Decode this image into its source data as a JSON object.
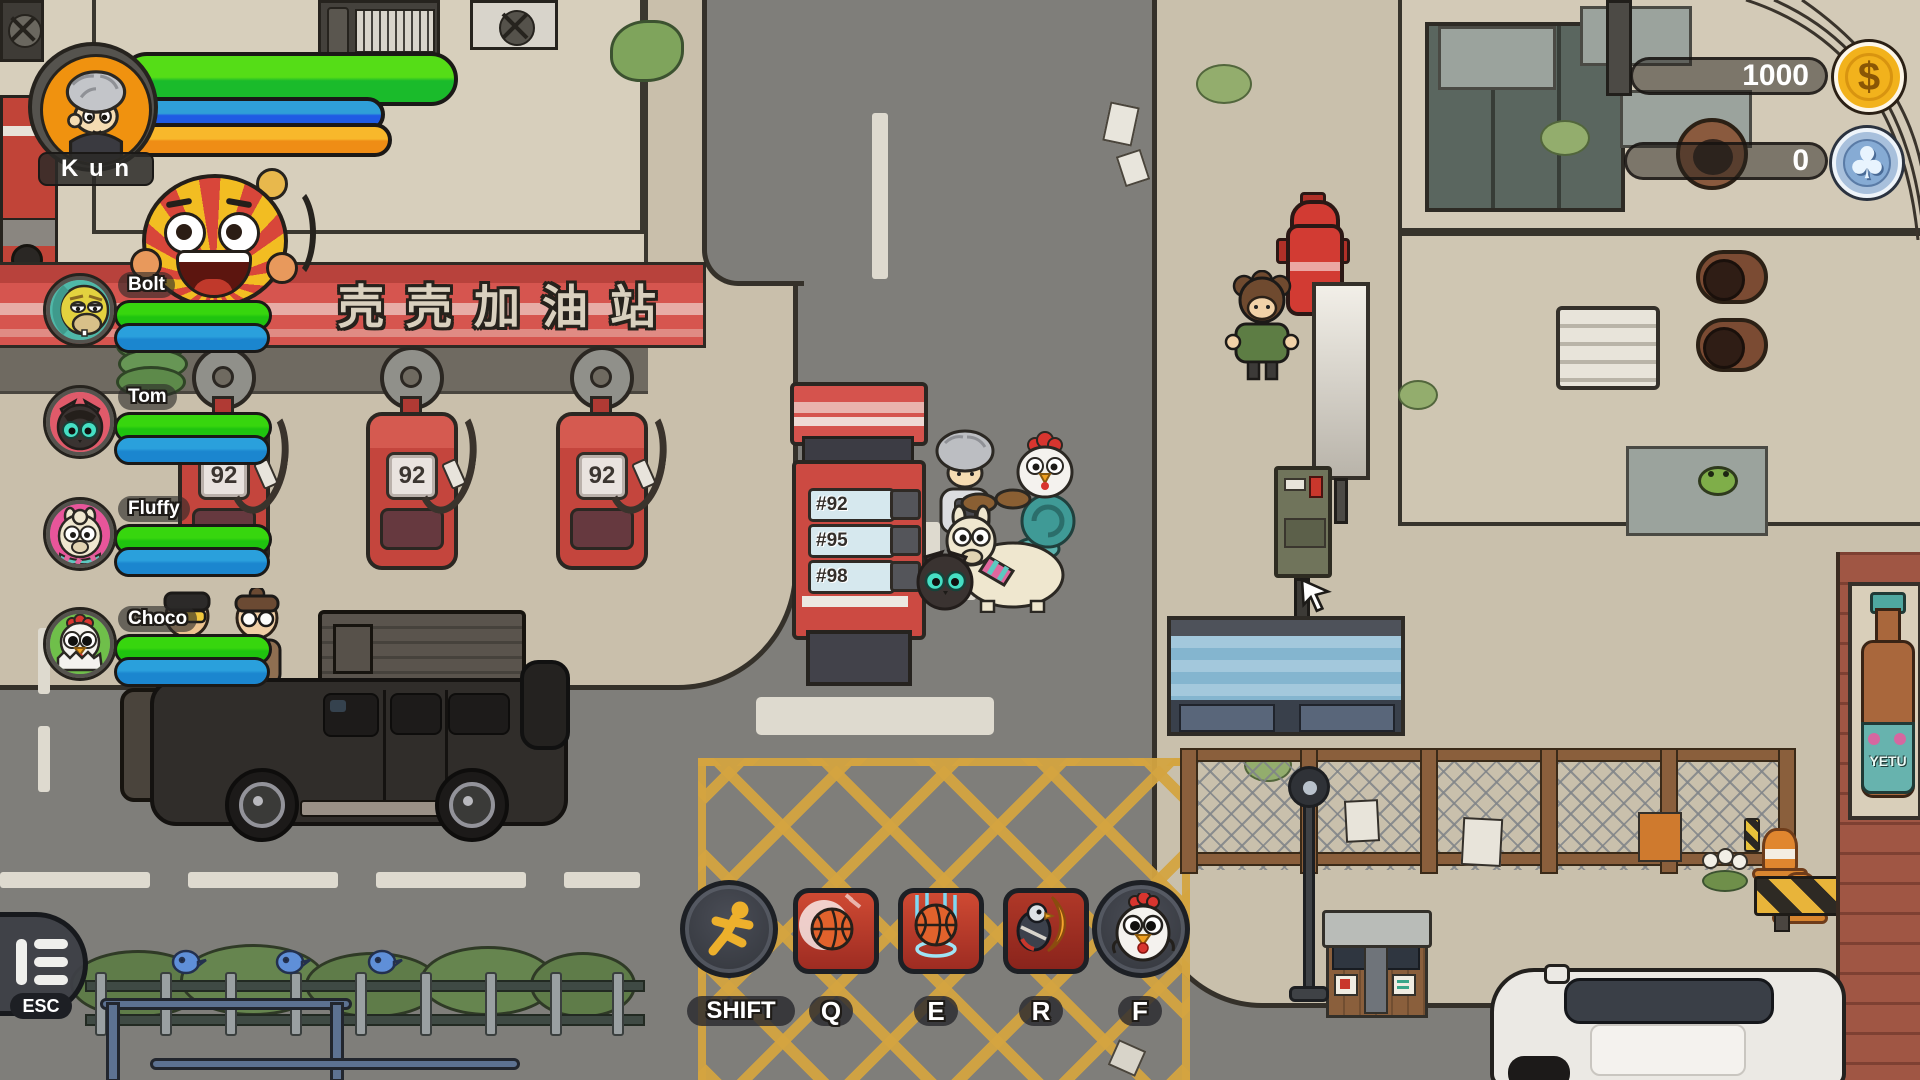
{
  "player": {
    "name": "K u n",
    "hp_pct": 100,
    "mp_pct": 78,
    "stamina_pct": 80
  },
  "party": [
    {
      "name": "Bolt",
      "species": "turtle",
      "hp_pct": 100,
      "mp_pct": 100
    },
    {
      "name": "Tom",
      "species": "cat",
      "hp_pct": 100,
      "mp_pct": 100
    },
    {
      "name": "Fluffy",
      "species": "alpaca",
      "hp_pct": 100,
      "mp_pct": 100
    },
    {
      "name": "Choco",
      "species": "chicken",
      "hp_pct": 100,
      "mp_pct": 100
    }
  ],
  "currencies": [
    {
      "value": "1000",
      "icon": "dollar-coin-icon"
    },
    {
      "value": "0",
      "icon": "club-chip-icon"
    }
  ],
  "skillbar": {
    "slots": [
      {
        "key": "SHIFT",
        "icon": "sprint-icon"
      },
      {
        "key": "Q",
        "icon": "basketball-shot-icon"
      },
      {
        "key": "E",
        "icon": "basketball-dunk-icon"
      },
      {
        "key": "R",
        "icon": "eagle-flame-icon"
      },
      {
        "key": "F",
        "icon": "chicken-summon-icon"
      }
    ]
  },
  "menu": {
    "label": "ESC"
  },
  "scene": {
    "gas_station_sign": "壳壳加油站",
    "pump_label": "92",
    "price_sign_rows": [
      "#92",
      "#95",
      "#98"
    ],
    "bottle_poster_text": "YETU"
  },
  "colors": {
    "hp_green": "#3ed314",
    "mp_blue": "#2a8fe0",
    "stamina_orange": "#f5a623",
    "gold_coin": "#f2b21c",
    "chip_blue": "#8fb3d9",
    "canopy_red": "#d6554f",
    "outline": "#2b2722"
  }
}
